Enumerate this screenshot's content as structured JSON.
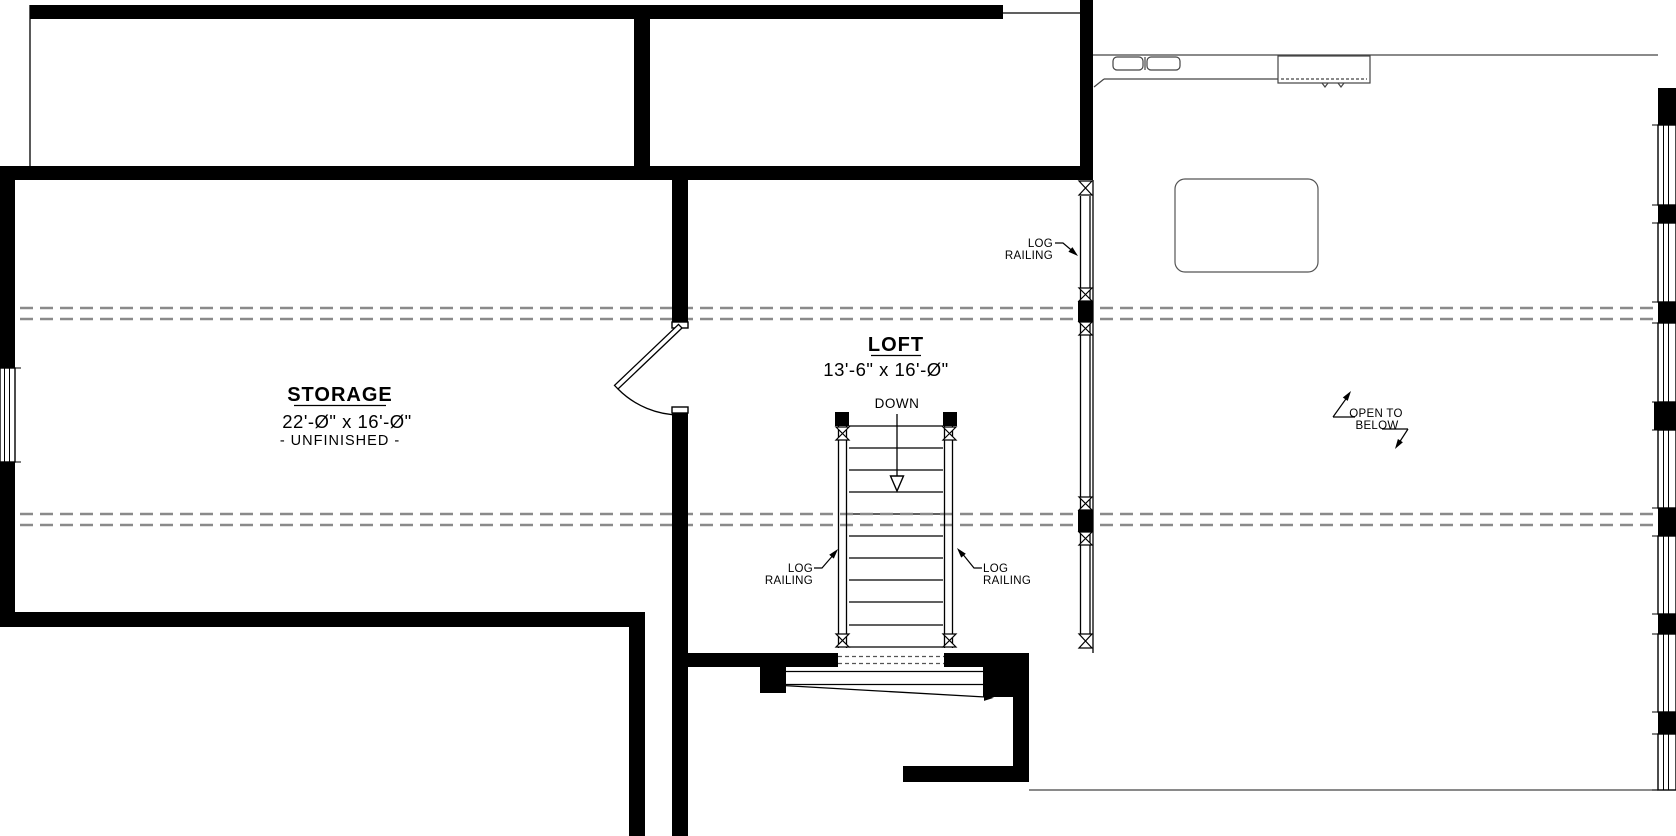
{
  "rooms": {
    "storage": {
      "name": "STORAGE",
      "dims": "22'-Ø\" x 16'-Ø\"",
      "note": "- UNFINISHED -"
    },
    "loft": {
      "name": "LOFT",
      "dims": "13'-6\" x 16'-Ø\""
    }
  },
  "annotations": {
    "down": "DOWN",
    "log_railing": {
      "line1": "LOG",
      "line2": "RAILING"
    },
    "open_to_below": {
      "line1": "OPEN TO",
      "line2": "BELOW"
    }
  },
  "colors": {
    "wall": "#000000",
    "dashed_reference": "#8a8a8a",
    "below_floor_lines": "#444444",
    "background": "#ffffff"
  }
}
